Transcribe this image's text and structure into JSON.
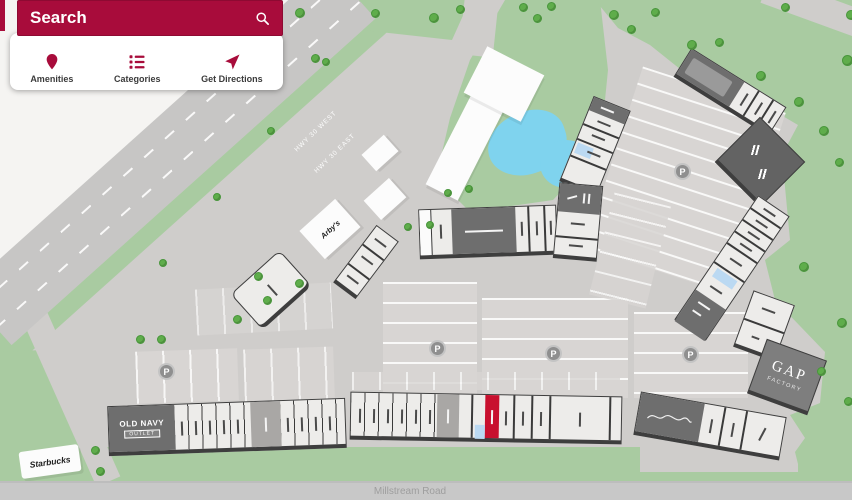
{
  "search": {
    "placeholder": "Search"
  },
  "toolbar": {
    "amenities": "Amenities",
    "categories": "Categories",
    "directions": "Get Directions"
  },
  "map": {
    "road_labels": {
      "hwy_west": "HWY 30 WEST",
      "hwy_east": "HWY 30 EAST",
      "millstream": "Millstream Road"
    },
    "store_labels": {
      "arbys": "Arby's",
      "starbucks": "Starbucks",
      "old_navy": "OLD NAVY",
      "old_navy_outlet": "OUTLET",
      "gap": "GAP",
      "gap_factory": "FACTORY"
    },
    "parking_label": "P"
  },
  "colors": {
    "brand_red": "#A80C3B",
    "grass": "#A9CBA1",
    "tree": "#5FAD4B",
    "pavement": "#CFCDCB",
    "parking": "#D8D5D3",
    "building_light": "#EDECEA",
    "building_dark": "#6E6E6E",
    "water": "#7FD3EE",
    "highlight_red": "#C8102E",
    "restroom_blue": "#BBD9F2"
  }
}
